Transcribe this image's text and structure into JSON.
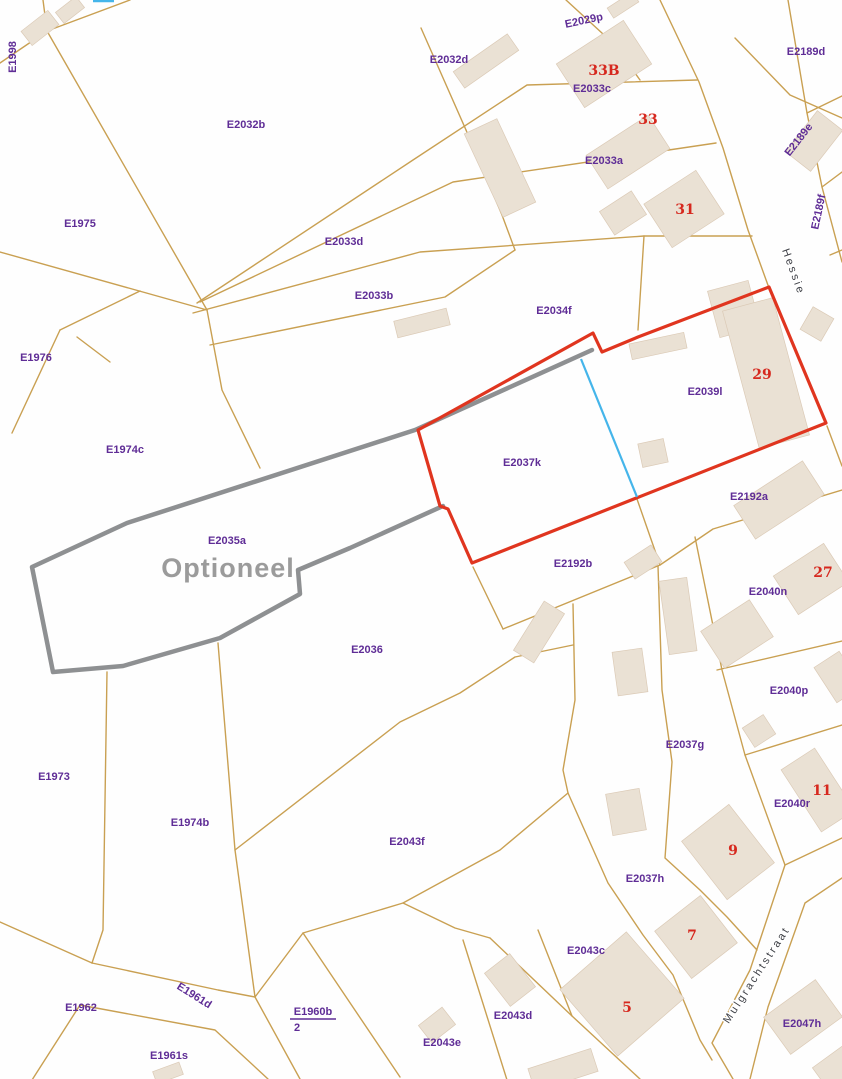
{
  "map": {
    "width": 842,
    "height": 1079,
    "colors": {
      "background": "#fefefe",
      "parcel_line": "#c9a052",
      "building": "#eae1d4",
      "building_edge": "#dbcab6",
      "selection_outline": "#e0351f",
      "optional_outline": "#8e9092",
      "divider_line": "#45b5ea",
      "parcel_label": "#5f2d96",
      "house_number": "#d6281e",
      "street_name": "#3f4147",
      "optioneel_text": "#9b9b9b"
    },
    "special_labels": [
      {
        "text": "Optioneel",
        "x": 228,
        "y": 570,
        "size": 27
      }
    ],
    "street_names": [
      {
        "text": "Hessie",
        "x": 793,
        "y": 272,
        "rot": 70
      },
      {
        "text": "Mulgrachtstraat",
        "x": 757,
        "y": 975,
        "rot": -57
      }
    ],
    "parcel_labels": [
      {
        "text": "E1998",
        "x": 13,
        "y": 57,
        "rot": -90
      },
      {
        "text": "E2029p",
        "x": 584,
        "y": 21,
        "rot": -12
      },
      {
        "text": "E2032d",
        "x": 449,
        "y": 60
      },
      {
        "text": "E2033c",
        "x": 592,
        "y": 89
      },
      {
        "text": "E2189d",
        "x": 806,
        "y": 52
      },
      {
        "text": "E2032b",
        "x": 246,
        "y": 125
      },
      {
        "text": "E2189e",
        "x": 799,
        "y": 140,
        "rot": -52
      },
      {
        "text": "E2033a",
        "x": 604,
        "y": 161
      },
      {
        "text": "E2189f",
        "x": 819,
        "y": 212,
        "rot": -78
      },
      {
        "text": "E1975",
        "x": 80,
        "y": 224
      },
      {
        "text": "E2033d",
        "x": 344,
        "y": 242
      },
      {
        "text": "E2033b",
        "x": 374,
        "y": 296
      },
      {
        "text": "E2034f",
        "x": 554,
        "y": 311
      },
      {
        "text": "E1976",
        "x": 36,
        "y": 358
      },
      {
        "text": "E2039l",
        "x": 705,
        "y": 392
      },
      {
        "text": "E1974c",
        "x": 125,
        "y": 450
      },
      {
        "text": "E2037k",
        "x": 522,
        "y": 463
      },
      {
        "text": "E2192a",
        "x": 749,
        "y": 497
      },
      {
        "text": "E2035a",
        "x": 227,
        "y": 541
      },
      {
        "text": "E2192b",
        "x": 573,
        "y": 564
      },
      {
        "text": "E2040n",
        "x": 768,
        "y": 592
      },
      {
        "text": "E2036",
        "x": 367,
        "y": 650
      },
      {
        "text": "E2040p",
        "x": 789,
        "y": 691
      },
      {
        "text": "E2037g",
        "x": 685,
        "y": 745
      },
      {
        "text": "E1973",
        "x": 54,
        "y": 777
      },
      {
        "text": "E2040r",
        "x": 792,
        "y": 804
      },
      {
        "text": "E1974b",
        "x": 190,
        "y": 823
      },
      {
        "text": "E2043f",
        "x": 407,
        "y": 842
      },
      {
        "text": "E2037h",
        "x": 645,
        "y": 879
      },
      {
        "text": "E2043c",
        "x": 586,
        "y": 951
      },
      {
        "text": "E1962",
        "x": 81,
        "y": 1008
      },
      {
        "text": "E1961d",
        "x": 194,
        "y": 996,
        "rot": 32
      },
      {
        "text": "E1960b",
        "x": 313,
        "y": 1012,
        "underline": true
      },
      {
        "text": "2",
        "x": 297,
        "y": 1028
      },
      {
        "text": "E2043d",
        "x": 513,
        "y": 1016
      },
      {
        "text": "E2047h",
        "x": 802,
        "y": 1024
      },
      {
        "text": "E2043e",
        "x": 442,
        "y": 1043
      },
      {
        "text": "E1961s",
        "x": 169,
        "y": 1056
      }
    ],
    "house_numbers": [
      {
        "text": "33B",
        "x": 604,
        "y": 71
      },
      {
        "text": "33",
        "x": 648,
        "y": 120
      },
      {
        "text": "31",
        "x": 685,
        "y": 210
      },
      {
        "text": "29",
        "x": 762,
        "y": 375
      },
      {
        "text": "27",
        "x": 823,
        "y": 573
      },
      {
        "text": "11",
        "x": 822,
        "y": 791
      },
      {
        "text": "9",
        "x": 733,
        "y": 851
      },
      {
        "text": "7",
        "x": 692,
        "y": 936
      },
      {
        "text": "5",
        "x": 627,
        "y": 1008
      }
    ],
    "selection_polygon": {
      "points": [
        [
          418,
          430
        ],
        [
          593,
          333
        ],
        [
          602,
          352
        ],
        [
          638,
          337
        ],
        [
          769,
          287
        ],
        [
          826,
          423
        ],
        [
          472,
          563
        ],
        [
          448,
          509
        ],
        [
          440,
          506
        ]
      ]
    },
    "optional_polyline": {
      "points": [
        [
          592,
          350
        ],
        [
          415,
          430
        ],
        [
          127,
          523
        ],
        [
          32,
          567
        ],
        [
          53,
          672
        ],
        [
          123,
          666
        ],
        [
          220,
          638
        ],
        [
          300,
          594
        ],
        [
          298,
          570
        ],
        [
          350,
          548
        ],
        [
          443,
          506
        ]
      ]
    },
    "divider_line": {
      "points": [
        [
          581,
          359
        ],
        [
          637,
          497
        ]
      ]
    },
    "edge_tick": {
      "points": [
        [
          93,
          1
        ],
        [
          114,
          1
        ]
      ]
    },
    "parcel_lines": [
      [
        [
          0,
          63
        ],
        [
          47,
          31
        ],
        [
          130,
          0
        ]
      ],
      [
        [
          43,
          0
        ],
        [
          47,
          31
        ]
      ],
      [
        [
          47,
          31
        ],
        [
          207,
          310
        ]
      ],
      [
        [
          0,
          252
        ],
        [
          207,
          310
        ]
      ],
      [
        [
          60,
          330
        ],
        [
          12,
          433
        ]
      ],
      [
        [
          60,
          330
        ],
        [
          140,
          291
        ]
      ],
      [
        [
          77,
          337
        ],
        [
          110,
          362
        ]
      ],
      [
        [
          207,
          310
        ],
        [
          222,
          390
        ],
        [
          260,
          468
        ]
      ],
      [
        [
          197,
          303
        ],
        [
          413,
          160
        ],
        [
          527,
          85
        ],
        [
          697,
          80
        ]
      ],
      [
        [
          200,
          302
        ],
        [
          453,
          182
        ],
        [
          716,
          143
        ]
      ],
      [
        [
          193,
          313
        ],
        [
          420,
          252
        ],
        [
          644,
          236
        ],
        [
          752,
          236
        ]
      ],
      [
        [
          210,
          345
        ],
        [
          445,
          297
        ],
        [
          515,
          250
        ]
      ],
      [
        [
          466,
          130
        ],
        [
          502,
          215
        ],
        [
          515,
          250
        ]
      ],
      [
        [
          421,
          28
        ],
        [
          466,
          130
        ]
      ],
      [
        [
          566,
          0
        ],
        [
          615,
          45
        ],
        [
          640,
          80
        ]
      ],
      [
        [
          644,
          236
        ],
        [
          638,
          330
        ]
      ],
      [
        [
          660,
          0
        ],
        [
          699,
          82
        ],
        [
          723,
          148
        ],
        [
          748,
          230
        ],
        [
          769,
          288
        ]
      ],
      [
        [
          788,
          0
        ],
        [
          807,
          113
        ],
        [
          822,
          187
        ],
        [
          842,
          262
        ]
      ],
      [
        [
          807,
          113
        ],
        [
          842,
          96
        ]
      ],
      [
        [
          822,
          187
        ],
        [
          842,
          172
        ]
      ],
      [
        [
          735,
          38
        ],
        [
          790,
          95
        ],
        [
          842,
          118
        ]
      ],
      [
        [
          830,
          255
        ],
        [
          842,
          250
        ]
      ],
      [
        [
          827,
          426
        ],
        [
          842,
          466
        ]
      ],
      [
        [
          503,
          629
        ],
        [
          660,
          565
        ],
        [
          713,
          529
        ],
        [
          842,
          490
        ]
      ],
      [
        [
          473,
          567
        ],
        [
          503,
          629
        ]
      ],
      [
        [
          637,
          499
        ],
        [
          660,
          565
        ]
      ],
      [
        [
          573,
          604
        ],
        [
          575,
          700
        ],
        [
          563,
          770
        ],
        [
          568,
          793
        ],
        [
          608,
          883
        ],
        [
          643,
          935
        ],
        [
          673,
          975
        ],
        [
          700,
          1040
        ],
        [
          712,
          1060
        ]
      ],
      [
        [
          658,
          566
        ],
        [
          662,
          690
        ],
        [
          672,
          762
        ],
        [
          665,
          858
        ],
        [
          700,
          890
        ],
        [
          727,
          917
        ],
        [
          757,
          950
        ]
      ],
      [
        [
          695,
          537
        ],
        [
          722,
          670
        ],
        [
          745,
          755
        ],
        [
          785,
          865
        ]
      ],
      [
        [
          717,
          670
        ],
        [
          842,
          641
        ]
      ],
      [
        [
          745,
          755
        ],
        [
          842,
          725
        ]
      ],
      [
        [
          842,
          838
        ],
        [
          785,
          865
        ],
        [
          750,
          970
        ],
        [
          712,
          1043
        ],
        [
          733,
          1079
        ]
      ],
      [
        [
          842,
          878
        ],
        [
          805,
          903
        ],
        [
          768,
          1007
        ],
        [
          750,
          1079
        ]
      ],
      [
        [
          218,
          643
        ],
        [
          235,
          850
        ],
        [
          255,
          997
        ]
      ],
      [
        [
          568,
          793
        ],
        [
          500,
          850
        ],
        [
          403,
          903
        ],
        [
          303,
          933
        ],
        [
          255,
          997
        ]
      ],
      [
        [
          303,
          933
        ],
        [
          400,
          1077
        ]
      ],
      [
        [
          403,
          903
        ],
        [
          455,
          928
        ],
        [
          490,
          938
        ]
      ],
      [
        [
          490,
          938
        ],
        [
          572,
          1016
        ],
        [
          640,
          1079
        ]
      ],
      [
        [
          538,
          930
        ],
        [
          572,
          1016
        ]
      ],
      [
        [
          463,
          940
        ],
        [
          507,
          1080
        ]
      ],
      [
        [
          92,
          963
        ],
        [
          218,
          990
        ],
        [
          255,
          997
        ],
        [
          300,
          1079
        ]
      ],
      [
        [
          80,
          1005
        ],
        [
          215,
          1030
        ],
        [
          268,
          1079
        ]
      ],
      [
        [
          80,
          1005
        ],
        [
          32,
          1080
        ]
      ],
      [
        [
          92,
          963
        ],
        [
          0,
          922
        ]
      ],
      [
        [
          107,
          672
        ],
        [
          103,
          930
        ],
        [
          92,
          963
        ]
      ],
      [
        [
          235,
          850
        ],
        [
          400,
          722
        ],
        [
          460,
          693
        ],
        [
          515,
          657
        ],
        [
          573,
          645
        ]
      ]
    ],
    "buildings": [
      {
        "cx": 40,
        "cy": 28,
        "w": 34,
        "h": 18,
        "rot": -38
      },
      {
        "cx": 70,
        "cy": 10,
        "w": 26,
        "h": 14,
        "rot": -38
      },
      {
        "cx": 486,
        "cy": 61,
        "w": 66,
        "h": 20,
        "rot": -35
      },
      {
        "cx": 604,
        "cy": 64,
        "w": 80,
        "h": 52,
        "rot": -33
      },
      {
        "cx": 623,
        "cy": 5,
        "w": 30,
        "h": 12,
        "rot": -33
      },
      {
        "cx": 628,
        "cy": 152,
        "w": 74,
        "h": 40,
        "rot": -33
      },
      {
        "cx": 500,
        "cy": 168,
        "w": 36,
        "h": 92,
        "rot": -25
      },
      {
        "cx": 623,
        "cy": 213,
        "w": 38,
        "h": 28,
        "rot": -33
      },
      {
        "cx": 684,
        "cy": 209,
        "w": 62,
        "h": 52,
        "rot": -33
      },
      {
        "cx": 814,
        "cy": 141,
        "w": 52,
        "h": 32,
        "rot": -52
      },
      {
        "cx": 817,
        "cy": 324,
        "w": 26,
        "h": 24,
        "rot": -60
      },
      {
        "cx": 658,
        "cy": 346,
        "w": 56,
        "h": 16,
        "rot": -12
      },
      {
        "cx": 734,
        "cy": 309,
        "w": 42,
        "h": 48,
        "rot": -15
      },
      {
        "cx": 766,
        "cy": 373,
        "w": 52,
        "h": 142,
        "rot": -15
      },
      {
        "cx": 779,
        "cy": 500,
        "w": 82,
        "h": 40,
        "rot": -33
      },
      {
        "cx": 653,
        "cy": 453,
        "w": 26,
        "h": 24,
        "rot": -12
      },
      {
        "cx": 643,
        "cy": 562,
        "w": 32,
        "h": 20,
        "rot": -33
      },
      {
        "cx": 539,
        "cy": 632,
        "w": 58,
        "h": 24,
        "rot": -58
      },
      {
        "cx": 678,
        "cy": 616,
        "w": 28,
        "h": 74,
        "rot": -8
      },
      {
        "cx": 630,
        "cy": 672,
        "w": 30,
        "h": 44,
        "rot": -8
      },
      {
        "cx": 626,
        "cy": 812,
        "w": 34,
        "h": 42,
        "rot": -10
      },
      {
        "cx": 737,
        "cy": 634,
        "w": 58,
        "h": 44,
        "rot": -33
      },
      {
        "cx": 811,
        "cy": 579,
        "w": 60,
        "h": 46,
        "rot": -33
      },
      {
        "cx": 759,
        "cy": 731,
        "w": 25,
        "h": 23,
        "rot": -33
      },
      {
        "cx": 838,
        "cy": 677,
        "w": 30,
        "h": 42,
        "rot": -33
      },
      {
        "cx": 818,
        "cy": 790,
        "w": 40,
        "h": 74,
        "rot": -33
      },
      {
        "cx": 728,
        "cy": 852,
        "w": 60,
        "h": 74,
        "rot": -38
      },
      {
        "cx": 696,
        "cy": 937,
        "w": 58,
        "h": 60,
        "rot": -38
      },
      {
        "cx": 622,
        "cy": 994,
        "w": 88,
        "h": 88,
        "rot": -41
      },
      {
        "cx": 510,
        "cy": 980,
        "w": 32,
        "h": 42,
        "rot": -38
      },
      {
        "cx": 437,
        "cy": 1025,
        "w": 30,
        "h": 22,
        "rot": -38
      },
      {
        "cx": 563,
        "cy": 1070,
        "w": 66,
        "h": 24,
        "rot": -18
      },
      {
        "cx": 803,
        "cy": 1017,
        "w": 64,
        "h": 46,
        "rot": -36
      },
      {
        "cx": 836,
        "cy": 1068,
        "w": 38,
        "h": 28,
        "rot": -36
      },
      {
        "cx": 168,
        "cy": 1073,
        "w": 28,
        "h": 13,
        "rot": -20
      },
      {
        "cx": 422,
        "cy": 323,
        "w": 54,
        "h": 17,
        "rot": -14
      }
    ]
  }
}
